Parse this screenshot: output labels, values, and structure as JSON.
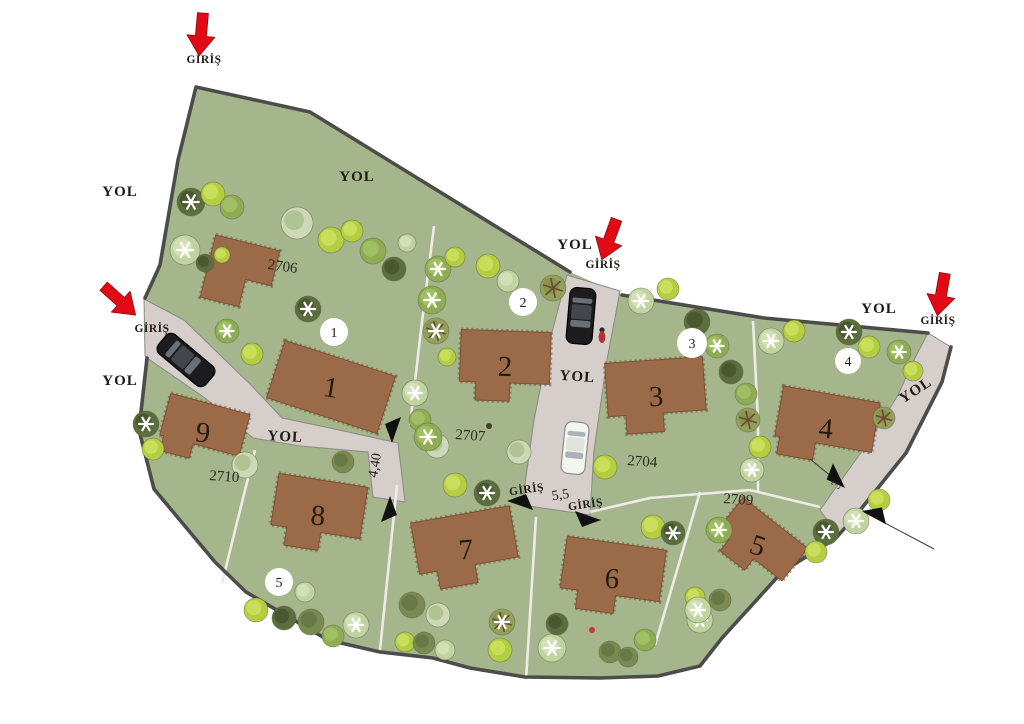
{
  "labels": {
    "road": "YOL",
    "entrance": "GİRİŞ"
  },
  "colors": {
    "background": "#ffffff",
    "grass": "#a5b58c",
    "road": "#d5cecb",
    "boundary": "#4c4c4a",
    "thin_line": "#eeebe6",
    "building": "#9b6a48",
    "building_hatch": "#6e4a2f",
    "badge_bg": "#ffffff",
    "red_arrow": "#e20a14",
    "dim_arrow": "#111111",
    "text": "#1f1b16"
  },
  "boundary": {
    "fill_points": "196,87 310,112 570,272 622,295 764,318 928,333 951,347 942,382 906,453 857,514 836,538 782,572 722,638 700,666 658,676 600,678 525,677 470,668 433,658 380,652 328,640 246,592 215,562 184,525 154,489 139,430 147,358 145,298 160,265 178,160",
    "stroke_segments": [
      "145,298 160,265 178,160 196,87 310,112 570,272",
      "622,295 764,318 928,333",
      "951,347 942,382 906,453 857,514 836,538 782,572 722,638 700,666 658,676 600,678 525,677 470,668 433,658 380,652 328,640 246,592 215,562 184,525 154,489 139,430 147,358"
    ]
  },
  "roads": [
    {
      "name": "road-west",
      "points": "144,299 184,320 252,386 282,418 330,428 398,443 405,502 373,497 368,452 300,446 253,438 205,398 150,360 145,356"
    },
    {
      "name": "road-middle",
      "points": "567,275 620,291 607,360 594,450 590,515 522,505 534,420 550,340"
    },
    {
      "name": "road-east",
      "points": "928,333 951,347 942,382 906,453 857,514 838,535 820,510 840,482 870,440 898,395 915,358"
    }
  ],
  "parcel_lines": [
    "434,226 421,330 410,425",
    "753,321 758,420 758,492",
    "255,450 222,583",
    "397,485 380,650",
    "536,517 526,680",
    "700,492 655,645",
    "590,512 650,498 750,490 820,507"
  ],
  "buildings": [
    {
      "number": "1",
      "x": 331,
      "y": 387,
      "w": 116,
      "h": 60,
      "rot": 18,
      "shape": "rect"
    },
    {
      "number": "2",
      "x": 505,
      "y": 366,
      "w": 90,
      "h": 70,
      "rot": 2,
      "shape": "step"
    },
    {
      "number": "3",
      "x": 656,
      "y": 396,
      "w": 98,
      "h": 72,
      "rot": -4,
      "shape": "step"
    },
    {
      "number": "4",
      "x": 826,
      "y": 428,
      "w": 98,
      "h": 68,
      "rot": 10,
      "shape": "stepL"
    },
    {
      "number": "5",
      "x": 758,
      "y": 545,
      "w": 82,
      "h": 56,
      "rot": 38,
      "shape": "step"
    },
    {
      "number": "6",
      "x": 612,
      "y": 578,
      "w": 100,
      "h": 70,
      "rot": 8,
      "shape": "step"
    },
    {
      "number": "7",
      "x": 466,
      "y": 549,
      "w": 100,
      "h": 70,
      "rot": -10,
      "shape": "step"
    },
    {
      "number": "8",
      "x": 318,
      "y": 515,
      "w": 90,
      "h": 70,
      "rot": 9,
      "shape": "step"
    },
    {
      "number": "9",
      "x": 203,
      "y": 432,
      "w": 82,
      "h": 58,
      "rot": 15,
      "shape": "stepL"
    },
    {
      "number": "",
      "x": 240,
      "y": 274,
      "w": 66,
      "h": 64,
      "rot": 14,
      "shape": "L"
    }
  ],
  "parcel_labels": [
    {
      "text": "2706",
      "x": 282,
      "y": 271,
      "rot": 8
    },
    {
      "text": "2707",
      "x": 470,
      "y": 440,
      "rot": 4
    },
    {
      "text": "2704",
      "x": 642,
      "y": 466,
      "rot": 4
    },
    {
      "text": "2710",
      "x": 224,
      "y": 481,
      "rot": 4
    },
    {
      "text": "2709",
      "x": 738,
      "y": 504,
      "rot": 4
    }
  ],
  "plot_badges": [
    {
      "number": "1",
      "x": 334,
      "y": 332,
      "r": 14
    },
    {
      "number": "2",
      "x": 523,
      "y": 302,
      "r": 14
    },
    {
      "number": "3",
      "x": 692,
      "y": 343,
      "r": 15
    },
    {
      "number": "4",
      "x": 848,
      "y": 361,
      "r": 13
    },
    {
      "number": "5",
      "x": 279,
      "y": 582,
      "r": 14
    }
  ],
  "road_labels": [
    {
      "x": 120,
      "y": 196,
      "rot": 0
    },
    {
      "x": 357,
      "y": 181,
      "rot": 0
    },
    {
      "x": 575,
      "y": 249,
      "rot": 0
    },
    {
      "x": 120,
      "y": 385,
      "rot": 0
    },
    {
      "x": 879,
      "y": 313,
      "rot": 0
    },
    {
      "x": 285,
      "y": 441,
      "rot": 3
    },
    {
      "x": 577,
      "y": 381,
      "rot": 4
    },
    {
      "x": 918,
      "y": 394,
      "rot": -33
    }
  ],
  "entrance_labels": [
    {
      "x": 204,
      "y": 63,
      "rot": 0
    },
    {
      "x": 603,
      "y": 268,
      "rot": 0
    },
    {
      "x": 938,
      "y": 324,
      "rot": 0
    },
    {
      "x": 152,
      "y": 332,
      "rot": 0
    },
    {
      "x": 527,
      "y": 493,
      "rot": -8
    },
    {
      "x": 586,
      "y": 508,
      "rot": -8
    }
  ],
  "red_arrows": [
    {
      "x": 201,
      "y": 35,
      "rot": 5
    },
    {
      "x": 609,
      "y": 240,
      "rot": 20
    },
    {
      "x": 941,
      "y": 295,
      "rot": 10
    },
    {
      "x": 120,
      "y": 301,
      "rot": -48
    }
  ],
  "measurements": [
    {
      "text": "4,40",
      "x": 379,
      "y": 466,
      "rot": -80,
      "size": 14
    },
    {
      "text": "5,5",
      "x": 561,
      "y": 499,
      "rot": -8,
      "size": 15
    },
    {
      "text": "3",
      "x": 840,
      "y": 487,
      "rot": -55,
      "size": 13
    }
  ],
  "dim_arrows": [
    {
      "x": 392,
      "y": 443,
      "rot": 90
    },
    {
      "x": 390,
      "y": 496,
      "rot": -90
    },
    {
      "x": 507,
      "y": 501,
      "rot": 180
    },
    {
      "x": 601,
      "y": 520,
      "rot": 0
    },
    {
      "x": 845,
      "y": 488,
      "rot": 45
    },
    {
      "x": 862,
      "y": 511,
      "rot": 190
    }
  ],
  "leader_lines": [
    {
      "x1": 810,
      "y1": 459,
      "x2": 843,
      "y2": 486
    },
    {
      "x1": 864,
      "y1": 512,
      "x2": 934,
      "y2": 549
    }
  ],
  "tree_palette": {
    "d": {
      "f": "#5c6e3f",
      "c": "#46552e"
    },
    "o": {
      "f": "#7a8a50",
      "c": "#657646"
    },
    "m": {
      "f": "#8fac55",
      "c": "#a3c167"
    },
    "b": {
      "f": "#b5cd40",
      "c": "#cde060"
    },
    "p": {
      "f": "#c2d3a2",
      "c": "#d3e2b8"
    },
    "t": {
      "f": "#cdd8b7",
      "c": "#aabf8d"
    },
    "r": {
      "f": "#93a05c",
      "c": "#849350"
    }
  },
  "trees": [
    [
      191,
      202,
      14,
      "d",
      1
    ],
    [
      213,
      194,
      12,
      "b",
      0
    ],
    [
      232,
      207,
      12,
      "m",
      0
    ],
    [
      185,
      250,
      15,
      "p",
      1
    ],
    [
      205,
      263,
      9,
      "d",
      0
    ],
    [
      222,
      255,
      8,
      "b",
      0
    ],
    [
      297,
      223,
      16,
      "t",
      0
    ],
    [
      331,
      240,
      13,
      "b",
      0
    ],
    [
      352,
      231,
      11,
      "b",
      0
    ],
    [
      373,
      251,
      13,
      "m",
      0
    ],
    [
      394,
      269,
      12,
      "d",
      0
    ],
    [
      407,
      243,
      9,
      "p",
      0
    ],
    [
      438,
      269,
      13,
      "m",
      1
    ],
    [
      455,
      257,
      10,
      "b",
      0
    ],
    [
      488,
      266,
      12,
      "b",
      0
    ],
    [
      508,
      281,
      11,
      "p",
      0
    ],
    [
      432,
      300,
      14,
      "m",
      1
    ],
    [
      436,
      331,
      13,
      "r",
      1
    ],
    [
      447,
      357,
      9,
      "b",
      0
    ],
    [
      308,
      309,
      13,
      "d",
      1
    ],
    [
      227,
      331,
      12,
      "m",
      1
    ],
    [
      252,
      354,
      11,
      "b",
      0
    ],
    [
      415,
      393,
      13,
      "p",
      1
    ],
    [
      420,
      420,
      11,
      "m",
      0
    ],
    [
      437,
      446,
      12,
      "t",
      0
    ],
    [
      553,
      288,
      13,
      "r",
      0
    ],
    [
      641,
      301,
      13,
      "p",
      1
    ],
    [
      668,
      289,
      11,
      "b",
      0
    ],
    [
      697,
      322,
      13,
      "d",
      0
    ],
    [
      717,
      346,
      12,
      "m",
      1
    ],
    [
      731,
      372,
      12,
      "d",
      0
    ],
    [
      746,
      394,
      11,
      "m",
      0
    ],
    [
      748,
      420,
      12,
      "r",
      0
    ],
    [
      760,
      447,
      11,
      "b",
      0
    ],
    [
      752,
      470,
      12,
      "p",
      1
    ],
    [
      771,
      341,
      13,
      "p",
      1
    ],
    [
      794,
      331,
      11,
      "b",
      0
    ],
    [
      849,
      332,
      13,
      "d",
      1
    ],
    [
      869,
      347,
      11,
      "b",
      0
    ],
    [
      899,
      352,
      12,
      "m",
      1
    ],
    [
      913,
      371,
      10,
      "b",
      0
    ],
    [
      884,
      418,
      11,
      "r",
      0
    ],
    [
      146,
      424,
      13,
      "d",
      1
    ],
    [
      153,
      449,
      11,
      "b",
      0
    ],
    [
      245,
      465,
      13,
      "t",
      0
    ],
    [
      343,
      462,
      11,
      "o",
      0
    ],
    [
      256,
      610,
      12,
      "b",
      0
    ],
    [
      284,
      618,
      12,
      "d",
      0
    ],
    [
      311,
      622,
      13,
      "o",
      0
    ],
    [
      333,
      636,
      11,
      "m",
      0
    ],
    [
      356,
      625,
      13,
      "p",
      1
    ],
    [
      305,
      592,
      10,
      "p",
      0
    ],
    [
      428,
      437,
      14,
      "m",
      1
    ],
    [
      455,
      485,
      12,
      "b",
      0
    ],
    [
      487,
      493,
      13,
      "d",
      1
    ],
    [
      519,
      452,
      12,
      "t",
      0
    ],
    [
      412,
      605,
      13,
      "o",
      0
    ],
    [
      438,
      615,
      12,
      "t",
      0
    ],
    [
      405,
      642,
      10,
      "b",
      0
    ],
    [
      424,
      643,
      11,
      "o",
      0
    ],
    [
      445,
      650,
      10,
      "p",
      0
    ],
    [
      502,
      622,
      13,
      "r",
      1
    ],
    [
      500,
      650,
      12,
      "b",
      0
    ],
    [
      552,
      648,
      14,
      "p",
      1
    ],
    [
      557,
      624,
      11,
      "d",
      0
    ],
    [
      610,
      652,
      11,
      "o",
      0
    ],
    [
      628,
      657,
      10,
      "o",
      0
    ],
    [
      645,
      640,
      11,
      "m",
      0
    ],
    [
      700,
      620,
      13,
      "p",
      1
    ],
    [
      695,
      597,
      10,
      "b",
      0
    ],
    [
      605,
      467,
      12,
      "b",
      0
    ],
    [
      653,
      527,
      12,
      "b",
      0
    ],
    [
      673,
      533,
      12,
      "d",
      1
    ],
    [
      719,
      530,
      13,
      "m",
      1
    ],
    [
      826,
      532,
      13,
      "d",
      1
    ],
    [
      816,
      552,
      11,
      "b",
      0
    ],
    [
      698,
      610,
      13,
      "p",
      1
    ],
    [
      720,
      600,
      11,
      "o",
      0
    ],
    [
      856,
      521,
      13,
      "p",
      1
    ],
    [
      879,
      500,
      11,
      "b",
      0
    ]
  ],
  "car_palette": {
    "black": {
      "body": "#1c1c1e",
      "roof": "#45454c",
      "win": "#6a6f78",
      "stroke": "#000000"
    },
    "white": {
      "body": "#f4f4f1",
      "roof": "#e2e2dc",
      "win": "#aab2b8",
      "stroke": "#8e8e88"
    }
  },
  "cars": [
    {
      "x": 186,
      "y": 360,
      "rot": 40,
      "len": 62,
      "wid": 25,
      "color": "black"
    },
    {
      "x": 581,
      "y": 316,
      "rot": 95,
      "len": 56,
      "wid": 26,
      "color": "black"
    },
    {
      "x": 575,
      "y": 448,
      "rot": 96,
      "len": 52,
      "wid": 24,
      "color": "white"
    }
  ],
  "person": {
    "x": 602,
    "y": 334
  },
  "specks": [
    {
      "x": 489,
      "y": 426,
      "c": "#4a3c28"
    },
    {
      "x": 592,
      "y": 630,
      "c": "#c23b2e"
    }
  ]
}
